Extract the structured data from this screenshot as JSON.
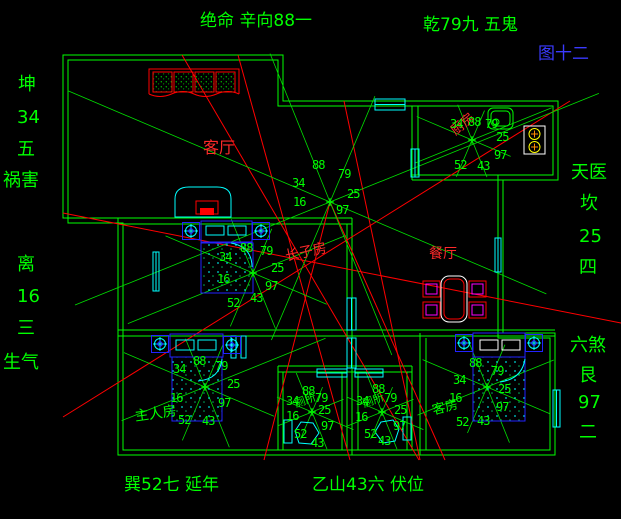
{
  "figure_label": "图十二",
  "perimeter": {
    "top_center": "绝命 辛向88一",
    "top_right": "乾79九 五鬼",
    "bottom_left": "巽52七  延年",
    "bottom_center": "乙山43六  伏位",
    "left_upper": {
      "trigram": "坤",
      "stars": "34",
      "rank": "五",
      "term": "祸害"
    },
    "left_lower": {
      "trigram": "离",
      "stars": "16",
      "rank": "三",
      "term": "生气"
    },
    "right_upper": {
      "term": "天医",
      "trigram": "坎",
      "stars": "25",
      "rank": "四"
    },
    "right_lower": {
      "term": "六煞",
      "trigram": "艮",
      "stars": "97",
      "rank": "二"
    }
  },
  "rooms": [
    {
      "id": "living",
      "label": "客厅",
      "label_color": "#ff2a2a",
      "numbers": [
        "88",
        "79",
        "34",
        "25",
        "16",
        "97"
      ]
    },
    {
      "id": "kitchen",
      "label": "厨房",
      "label_color": "#ff2a2a",
      "numbers": [
        "34",
        "88",
        "79",
        "25",
        "97",
        "43",
        "52"
      ]
    },
    {
      "id": "eldest-son",
      "label": "长子房",
      "label_color": "#ff2a2a",
      "numbers": [
        "88",
        "79",
        "34",
        "25",
        "16",
        "97",
        "43",
        "52"
      ]
    },
    {
      "id": "dining",
      "label": "餐厅",
      "label_color": "#ff2a2a",
      "numbers": []
    },
    {
      "id": "master",
      "label": "主人房",
      "label_color": "#00ff00",
      "numbers": [
        "88",
        "79",
        "34",
        "25",
        "16",
        "97",
        "43",
        "52"
      ]
    },
    {
      "id": "toilet-left",
      "label": "厕所",
      "label_color": "#00ff00",
      "numbers": [
        "88",
        "79",
        "34",
        "25",
        "16",
        "97",
        "52",
        "43"
      ]
    },
    {
      "id": "toilet-right",
      "label": "厕所",
      "label_color": "#00ff00",
      "numbers": [
        "88",
        "79",
        "34",
        "25",
        "16",
        "97",
        "52",
        "43"
      ]
    },
    {
      "id": "guest",
      "label": "客房",
      "label_color": "#00ff00",
      "numbers": [
        "88",
        "79",
        "34",
        "25",
        "16",
        "97",
        "43",
        "52"
      ]
    }
  ],
  "colors": {
    "background": "#000000",
    "wall_green": "#00ff00",
    "line_red": "#ff0000",
    "cyan": "#00ffff",
    "blue": "#2222ff",
    "magenta": "#ff00ff",
    "white": "#ffffff",
    "yellow": "#ffff00",
    "figure_blue": "#3a3aff"
  }
}
